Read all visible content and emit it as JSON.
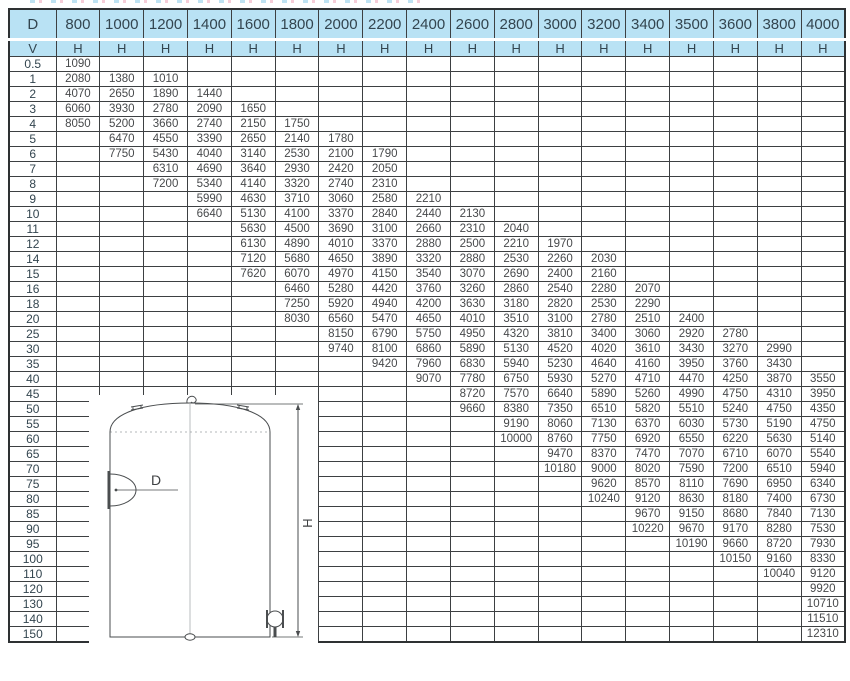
{
  "colors": {
    "header_blue": "#b9e2f4",
    "grid": "#3d4042",
    "outer_border": "#2e3133",
    "text": "#47494b",
    "header_text": "#33454f",
    "drawing_line": "#4a4d4f",
    "artifact_blue": "#a8d8ee",
    "artifact_pink": "#f2bccb"
  },
  "drawing": {
    "diameter_label": "D",
    "height_label": "H"
  },
  "table": {
    "corner_label": "D",
    "row_axis_label": "V",
    "unit_label": "H",
    "diameters": [
      "800",
      "1000",
      "1200",
      "1400",
      "1600",
      "1800",
      "2000",
      "2200",
      "2400",
      "2600",
      "2800",
      "3000",
      "3200",
      "3400",
      "3500",
      "3600",
      "3800",
      "4000"
    ],
    "rows": [
      {
        "v": "0.5",
        "h": [
          1090
        ]
      },
      {
        "v": "1",
        "h": [
          2080,
          1380,
          1010
        ]
      },
      {
        "v": "2",
        "h": [
          4070,
          2650,
          1890,
          1440
        ]
      },
      {
        "v": "3",
        "h": [
          6060,
          3930,
          2780,
          2090,
          1650
        ]
      },
      {
        "v": "4",
        "h": [
          8050,
          5200,
          3660,
          2740,
          2150,
          1750
        ]
      },
      {
        "v": "5",
        "h": [
          null,
          6470,
          4550,
          3390,
          2650,
          2140,
          1780
        ]
      },
      {
        "v": "6",
        "h": [
          null,
          7750,
          5430,
          4040,
          3140,
          2530,
          2100,
          1790
        ]
      },
      {
        "v": "7",
        "h": [
          null,
          null,
          6310,
          4690,
          3640,
          2930,
          2420,
          2050
        ]
      },
      {
        "v": "8",
        "h": [
          null,
          null,
          7200,
          5340,
          4140,
          3320,
          2740,
          2310
        ]
      },
      {
        "v": "9",
        "h": [
          null,
          null,
          null,
          5990,
          4630,
          3710,
          3060,
          2580,
          2210
        ]
      },
      {
        "v": "10",
        "h": [
          null,
          null,
          null,
          6640,
          5130,
          4100,
          3370,
          2840,
          2440,
          2130
        ]
      },
      {
        "v": "11",
        "h": [
          null,
          null,
          null,
          null,
          5630,
          4500,
          3690,
          3100,
          2660,
          2310,
          2040
        ]
      },
      {
        "v": "12",
        "h": [
          null,
          null,
          null,
          null,
          6130,
          4890,
          4010,
          3370,
          2880,
          2500,
          2210,
          1970
        ]
      },
      {
        "v": "14",
        "h": [
          null,
          null,
          null,
          null,
          7120,
          5680,
          4650,
          3890,
          3320,
          2880,
          2530,
          2260,
          2030
        ]
      },
      {
        "v": "15",
        "h": [
          null,
          null,
          null,
          null,
          7620,
          6070,
          4970,
          4150,
          3540,
          3070,
          2690,
          2400,
          2160
        ]
      },
      {
        "v": "16",
        "h": [
          null,
          null,
          null,
          null,
          null,
          6460,
          5280,
          4420,
          3760,
          3260,
          2860,
          2540,
          2280,
          2070
        ]
      },
      {
        "v": "18",
        "h": [
          null,
          null,
          null,
          null,
          null,
          7250,
          5920,
          4940,
          4200,
          3630,
          3180,
          2820,
          2530,
          2290
        ]
      },
      {
        "v": "20",
        "h": [
          null,
          null,
          null,
          null,
          null,
          8030,
          6560,
          5470,
          4650,
          4010,
          3510,
          3100,
          2780,
          2510,
          2400
        ]
      },
      {
        "v": "25",
        "h": [
          null,
          null,
          null,
          null,
          null,
          null,
          8150,
          6790,
          5750,
          4950,
          4320,
          3810,
          3400,
          3060,
          2920,
          2780
        ]
      },
      {
        "v": "30",
        "h": [
          null,
          null,
          null,
          null,
          null,
          null,
          9740,
          8100,
          6860,
          5890,
          5130,
          4520,
          4020,
          3610,
          3430,
          3270,
          2990
        ]
      },
      {
        "v": "35",
        "h": [
          null,
          null,
          null,
          null,
          null,
          null,
          null,
          9420,
          7960,
          6830,
          5940,
          5230,
          4640,
          4160,
          3950,
          3760,
          3430
        ]
      },
      {
        "v": "40",
        "h": [
          null,
          null,
          null,
          null,
          null,
          null,
          null,
          null,
          9070,
          7780,
          6750,
          5930,
          5270,
          4710,
          4470,
          4250,
          3870,
          3550
        ]
      },
      {
        "v": "45",
        "h": [
          null,
          null,
          null,
          null,
          null,
          null,
          null,
          null,
          null,
          8720,
          7570,
          6640,
          5890,
          5260,
          4990,
          4750,
          4310,
          3950
        ]
      },
      {
        "v": "50",
        "h": [
          null,
          null,
          null,
          null,
          null,
          null,
          null,
          null,
          null,
          9660,
          8380,
          7350,
          6510,
          5820,
          5510,
          5240,
          4750,
          4350
        ]
      },
      {
        "v": "55",
        "h": [
          null,
          null,
          null,
          null,
          null,
          null,
          null,
          null,
          null,
          null,
          9190,
          8060,
          7130,
          6370,
          6030,
          5730,
          5190,
          4750
        ]
      },
      {
        "v": "60",
        "h": [
          null,
          null,
          null,
          null,
          null,
          null,
          null,
          null,
          null,
          null,
          10000,
          8760,
          7750,
          6920,
          6550,
          6220,
          5630,
          5140
        ]
      },
      {
        "v": "65",
        "h": [
          null,
          null,
          null,
          null,
          null,
          null,
          null,
          null,
          null,
          null,
          null,
          9470,
          8370,
          7470,
          7070,
          6710,
          6070,
          5540
        ]
      },
      {
        "v": "70",
        "h": [
          null,
          null,
          null,
          null,
          null,
          null,
          null,
          null,
          null,
          null,
          null,
          10180,
          9000,
          8020,
          7590,
          7200,
          6510,
          5940
        ]
      },
      {
        "v": "75",
        "h": [
          null,
          null,
          null,
          null,
          null,
          null,
          null,
          null,
          null,
          null,
          null,
          null,
          9620,
          8570,
          8110,
          7690,
          6950,
          6340
        ]
      },
      {
        "v": "80",
        "h": [
          null,
          null,
          null,
          null,
          null,
          null,
          null,
          null,
          null,
          null,
          null,
          null,
          10240,
          9120,
          8630,
          8180,
          7400,
          6730
        ]
      },
      {
        "v": "85",
        "h": [
          null,
          null,
          null,
          null,
          null,
          null,
          null,
          null,
          null,
          null,
          null,
          null,
          null,
          9670,
          9150,
          8680,
          7840,
          7130
        ]
      },
      {
        "v": "90",
        "h": [
          null,
          null,
          null,
          null,
          null,
          null,
          null,
          null,
          null,
          null,
          null,
          null,
          null,
          10220,
          9670,
          9170,
          8280,
          7530
        ]
      },
      {
        "v": "95",
        "h": [
          null,
          null,
          null,
          null,
          null,
          null,
          null,
          null,
          null,
          null,
          null,
          null,
          null,
          null,
          10190,
          9660,
          8720,
          7930
        ]
      },
      {
        "v": "100",
        "h": [
          null,
          null,
          null,
          null,
          null,
          null,
          null,
          null,
          null,
          null,
          null,
          null,
          null,
          null,
          null,
          10150,
          9160,
          8330
        ]
      },
      {
        "v": "110",
        "h": [
          null,
          null,
          null,
          null,
          null,
          null,
          null,
          null,
          null,
          null,
          null,
          null,
          null,
          null,
          null,
          null,
          10040,
          9120
        ]
      },
      {
        "v": "120",
        "h": [
          null,
          null,
          null,
          null,
          null,
          null,
          null,
          null,
          null,
          null,
          null,
          null,
          null,
          null,
          null,
          null,
          null,
          9920
        ]
      },
      {
        "v": "130",
        "h": [
          null,
          null,
          null,
          null,
          null,
          null,
          null,
          null,
          null,
          null,
          null,
          null,
          null,
          null,
          null,
          null,
          null,
          10710
        ]
      },
      {
        "v": "140",
        "h": [
          null,
          null,
          null,
          null,
          null,
          null,
          null,
          null,
          null,
          null,
          null,
          null,
          null,
          null,
          null,
          null,
          null,
          11510
        ]
      },
      {
        "v": "150",
        "h": [
          null,
          null,
          null,
          null,
          null,
          null,
          null,
          null,
          null,
          null,
          null,
          null,
          null,
          null,
          null,
          null,
          null,
          12310
        ]
      }
    ]
  }
}
